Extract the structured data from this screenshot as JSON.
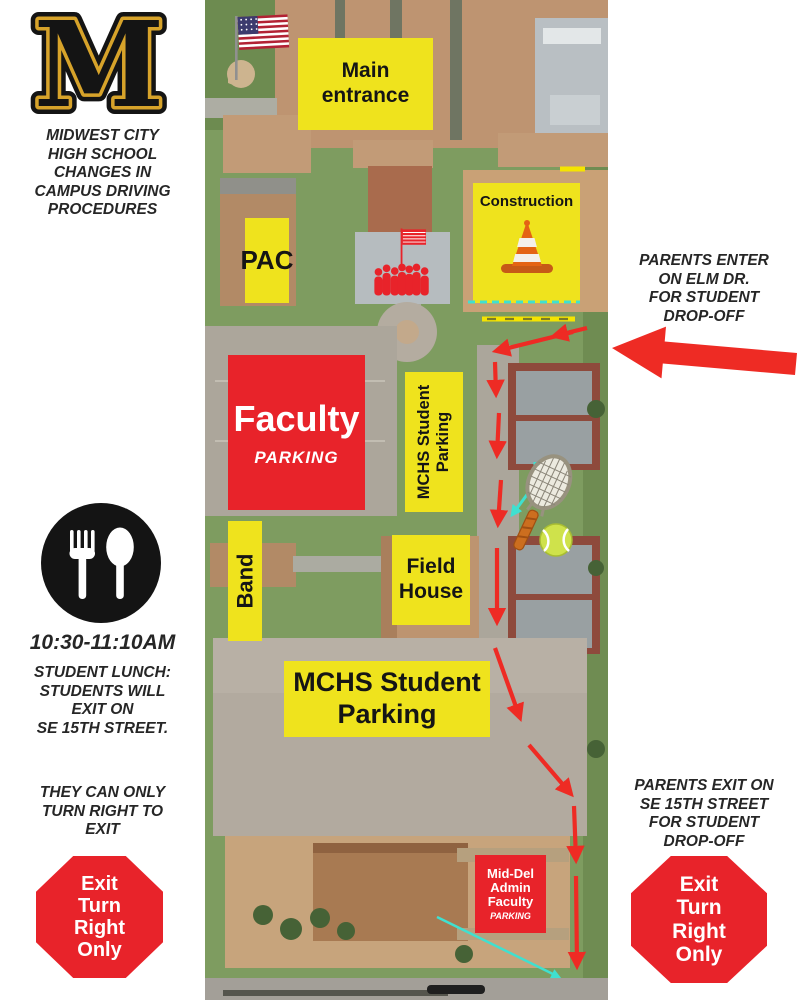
{
  "colors": {
    "yellow": "#EFE31D",
    "red": "#E8232A",
    "arrow-red": "#EE2B24",
    "cyan": "#3FE0D0",
    "gold": "#D7A32A",
    "ink": "#262626"
  },
  "left_panel": {
    "logo_letter": "M",
    "heading": "MIDWEST CITY\nHIGH SCHOOL\nCHANGES IN\nCAMPUS DRIVING\nPROCEDURES",
    "lunch_time": "10:30-11:10AM",
    "lunch_note": "STUDENT LUNCH:\nSTUDENTS WILL\nEXIT ON\nSE 15TH STREET.",
    "turn_note": "THEY CAN ONLY\nTURN RIGHT TO\nEXIT",
    "stop_sign_text": "Exit\nTurn\nRight\nOnly"
  },
  "right_panel": {
    "enter_note": "PARENTS ENTER\nON ELM DR.\nFOR STUDENT\nDROP-OFF",
    "exit_note": "PARENTS EXIT ON\nSE 15TH STREET\nFOR STUDENT\nDROP-OFF",
    "stop_sign_text": "Exit\nTurn\nRight\nOnly"
  },
  "map": {
    "labels": {
      "main_entrance": "Main\nentrance",
      "construction": "Construction",
      "pac": "PAC",
      "faculty_title": "Faculty",
      "faculty_sub": "PARKING",
      "student_parking_vertical": "MCHS Student\nParking",
      "band": "Band",
      "field_house": "Field\nHouse",
      "student_parking_main": "MCHS Student\nParking",
      "admin_title": "Mid-Del\nAdmin\nFaculty",
      "admin_sub": "PARKING"
    },
    "icons": {
      "us_flag": "us-flag-icon",
      "flag_assembly": "flag-assembly-icon",
      "traffic_cone": "traffic-cone-icon",
      "tennis_racket": "tennis-racket-icon",
      "tennis_ball": "tennis-ball-icon",
      "fork_and_spoon": "fork-and-spoon-icon",
      "stop_sign": "stop-sign-octagon",
      "drop_off_arrow": "left-arrow"
    }
  }
}
